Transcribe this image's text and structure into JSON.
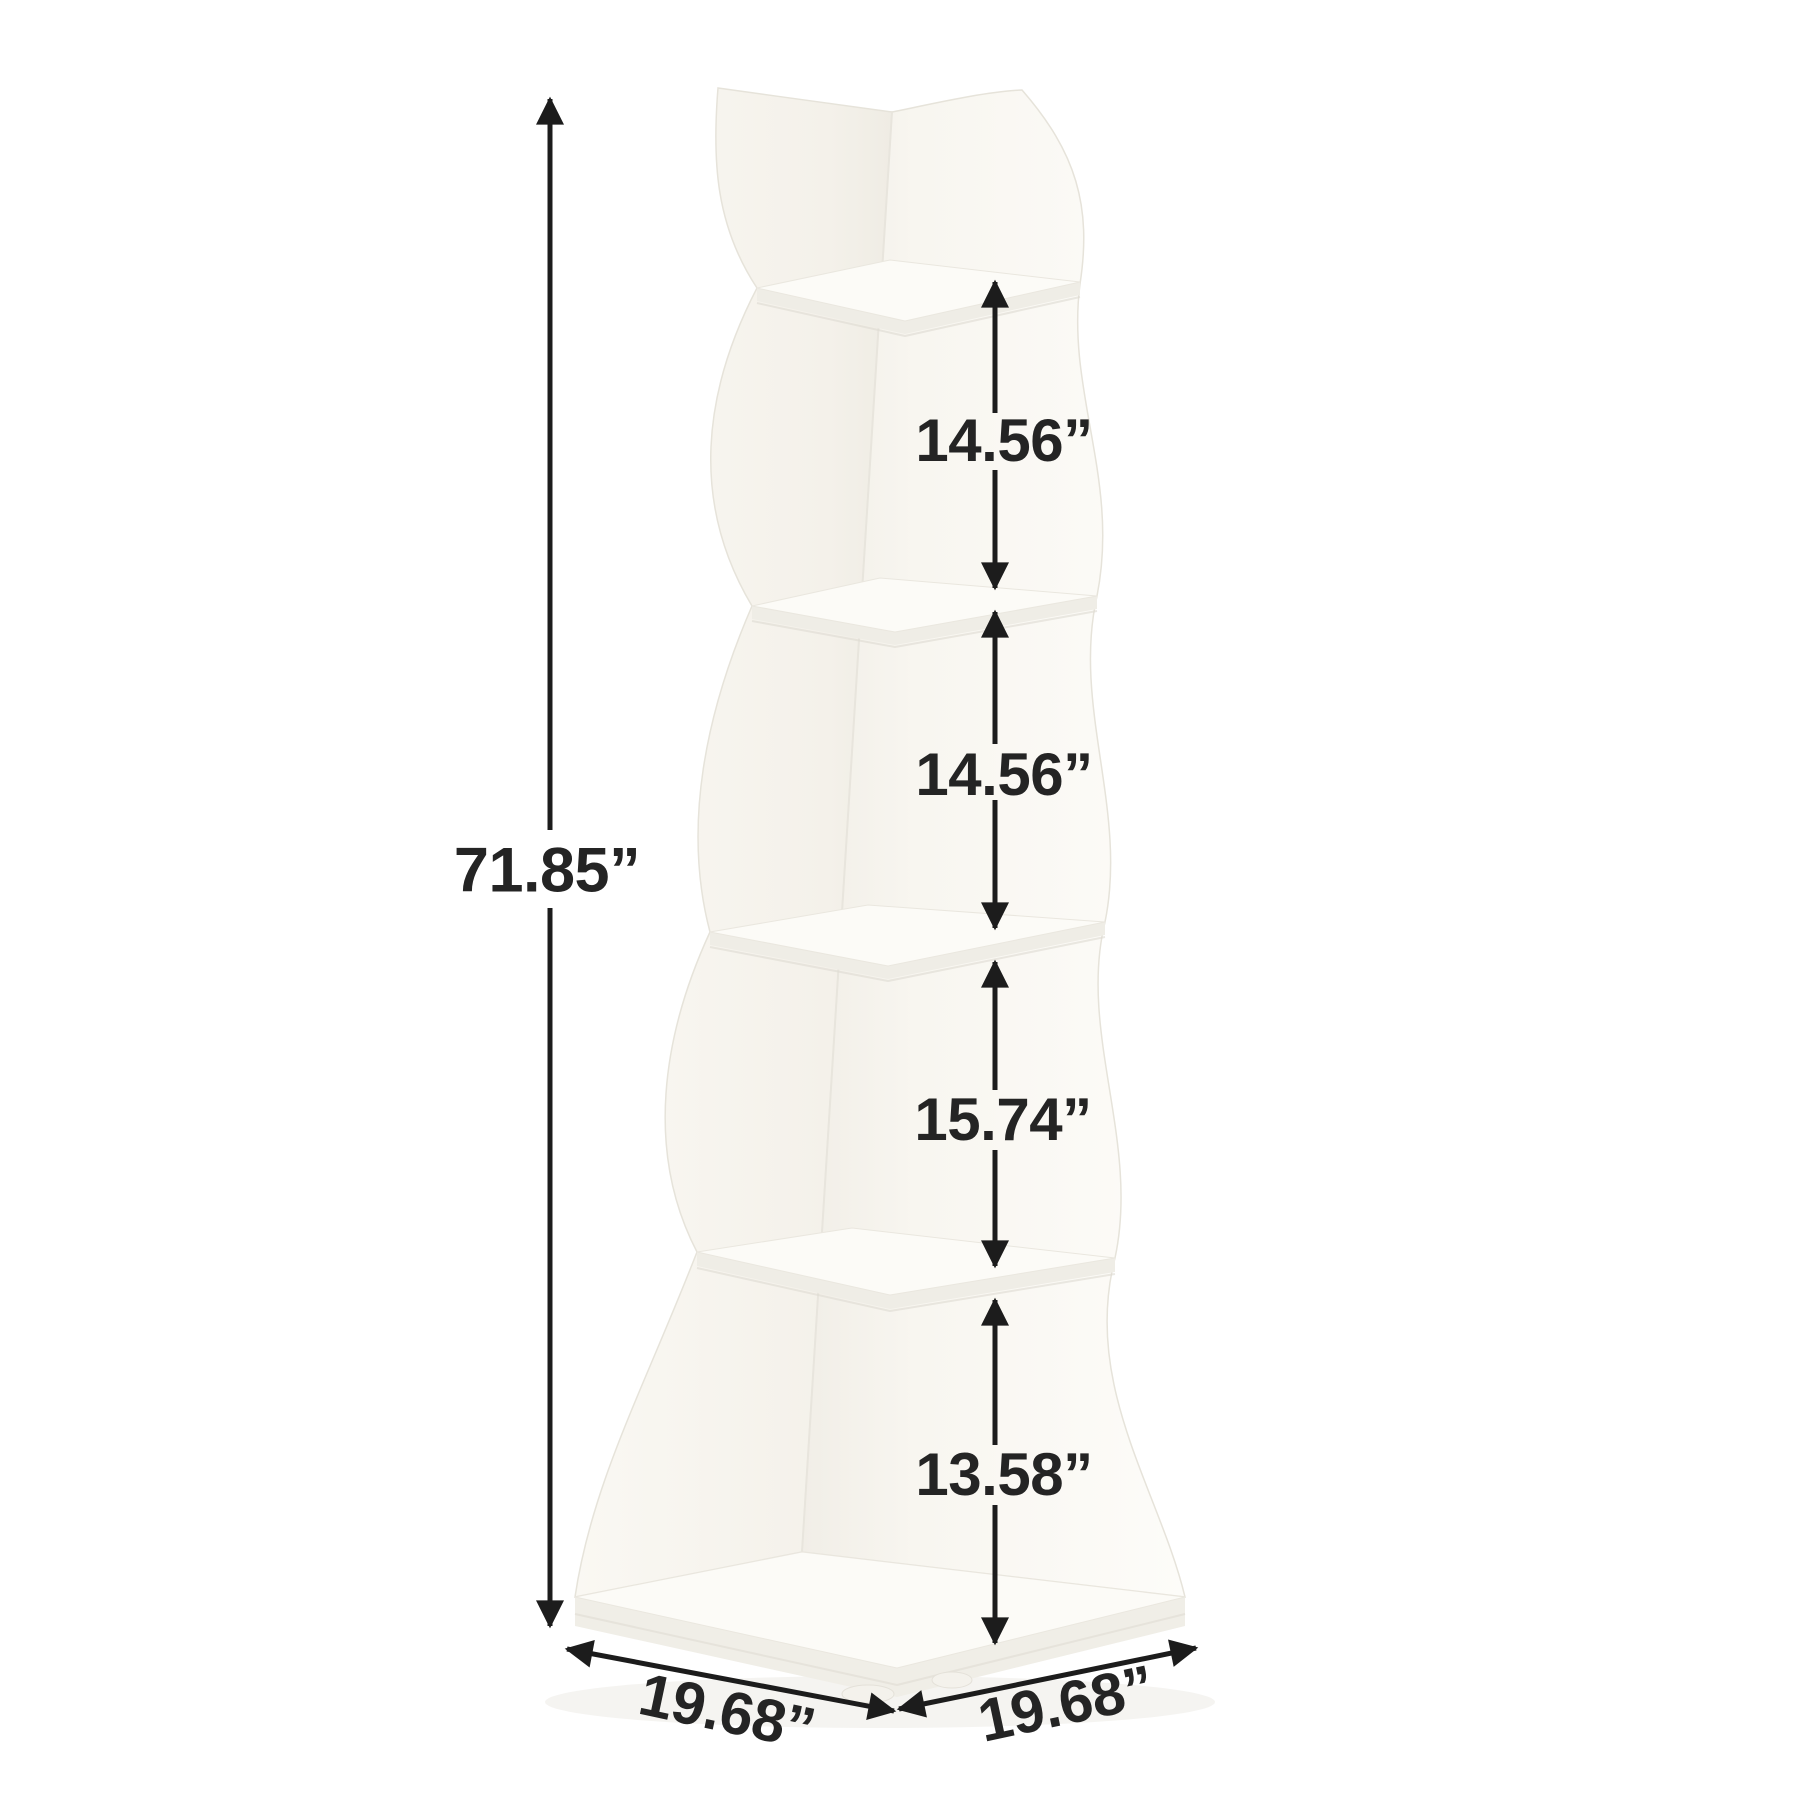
{
  "figure": {
    "kind": "corner-shelf-dimension-diagram",
    "background_color": "#ffffff",
    "ink_color": "#1c1c1c",
    "label_color": "#242424",
    "furniture_color": "#f8f6f1",
    "tiers_depicted": 5
  },
  "dimensions": {
    "height": {
      "label": "71.85”"
    },
    "gaps": [
      {
        "id": "tier-1-to-2",
        "label": "14.56”"
      },
      {
        "id": "tier-2-to-3",
        "label": "14.56”"
      },
      {
        "id": "tier-3-to-4",
        "label": "15.74”"
      },
      {
        "id": "tier-4-to-base",
        "label": "13.58”"
      }
    ],
    "base": {
      "left": {
        "label": "19.68”"
      },
      "right": {
        "label": "19.68”"
      }
    }
  }
}
